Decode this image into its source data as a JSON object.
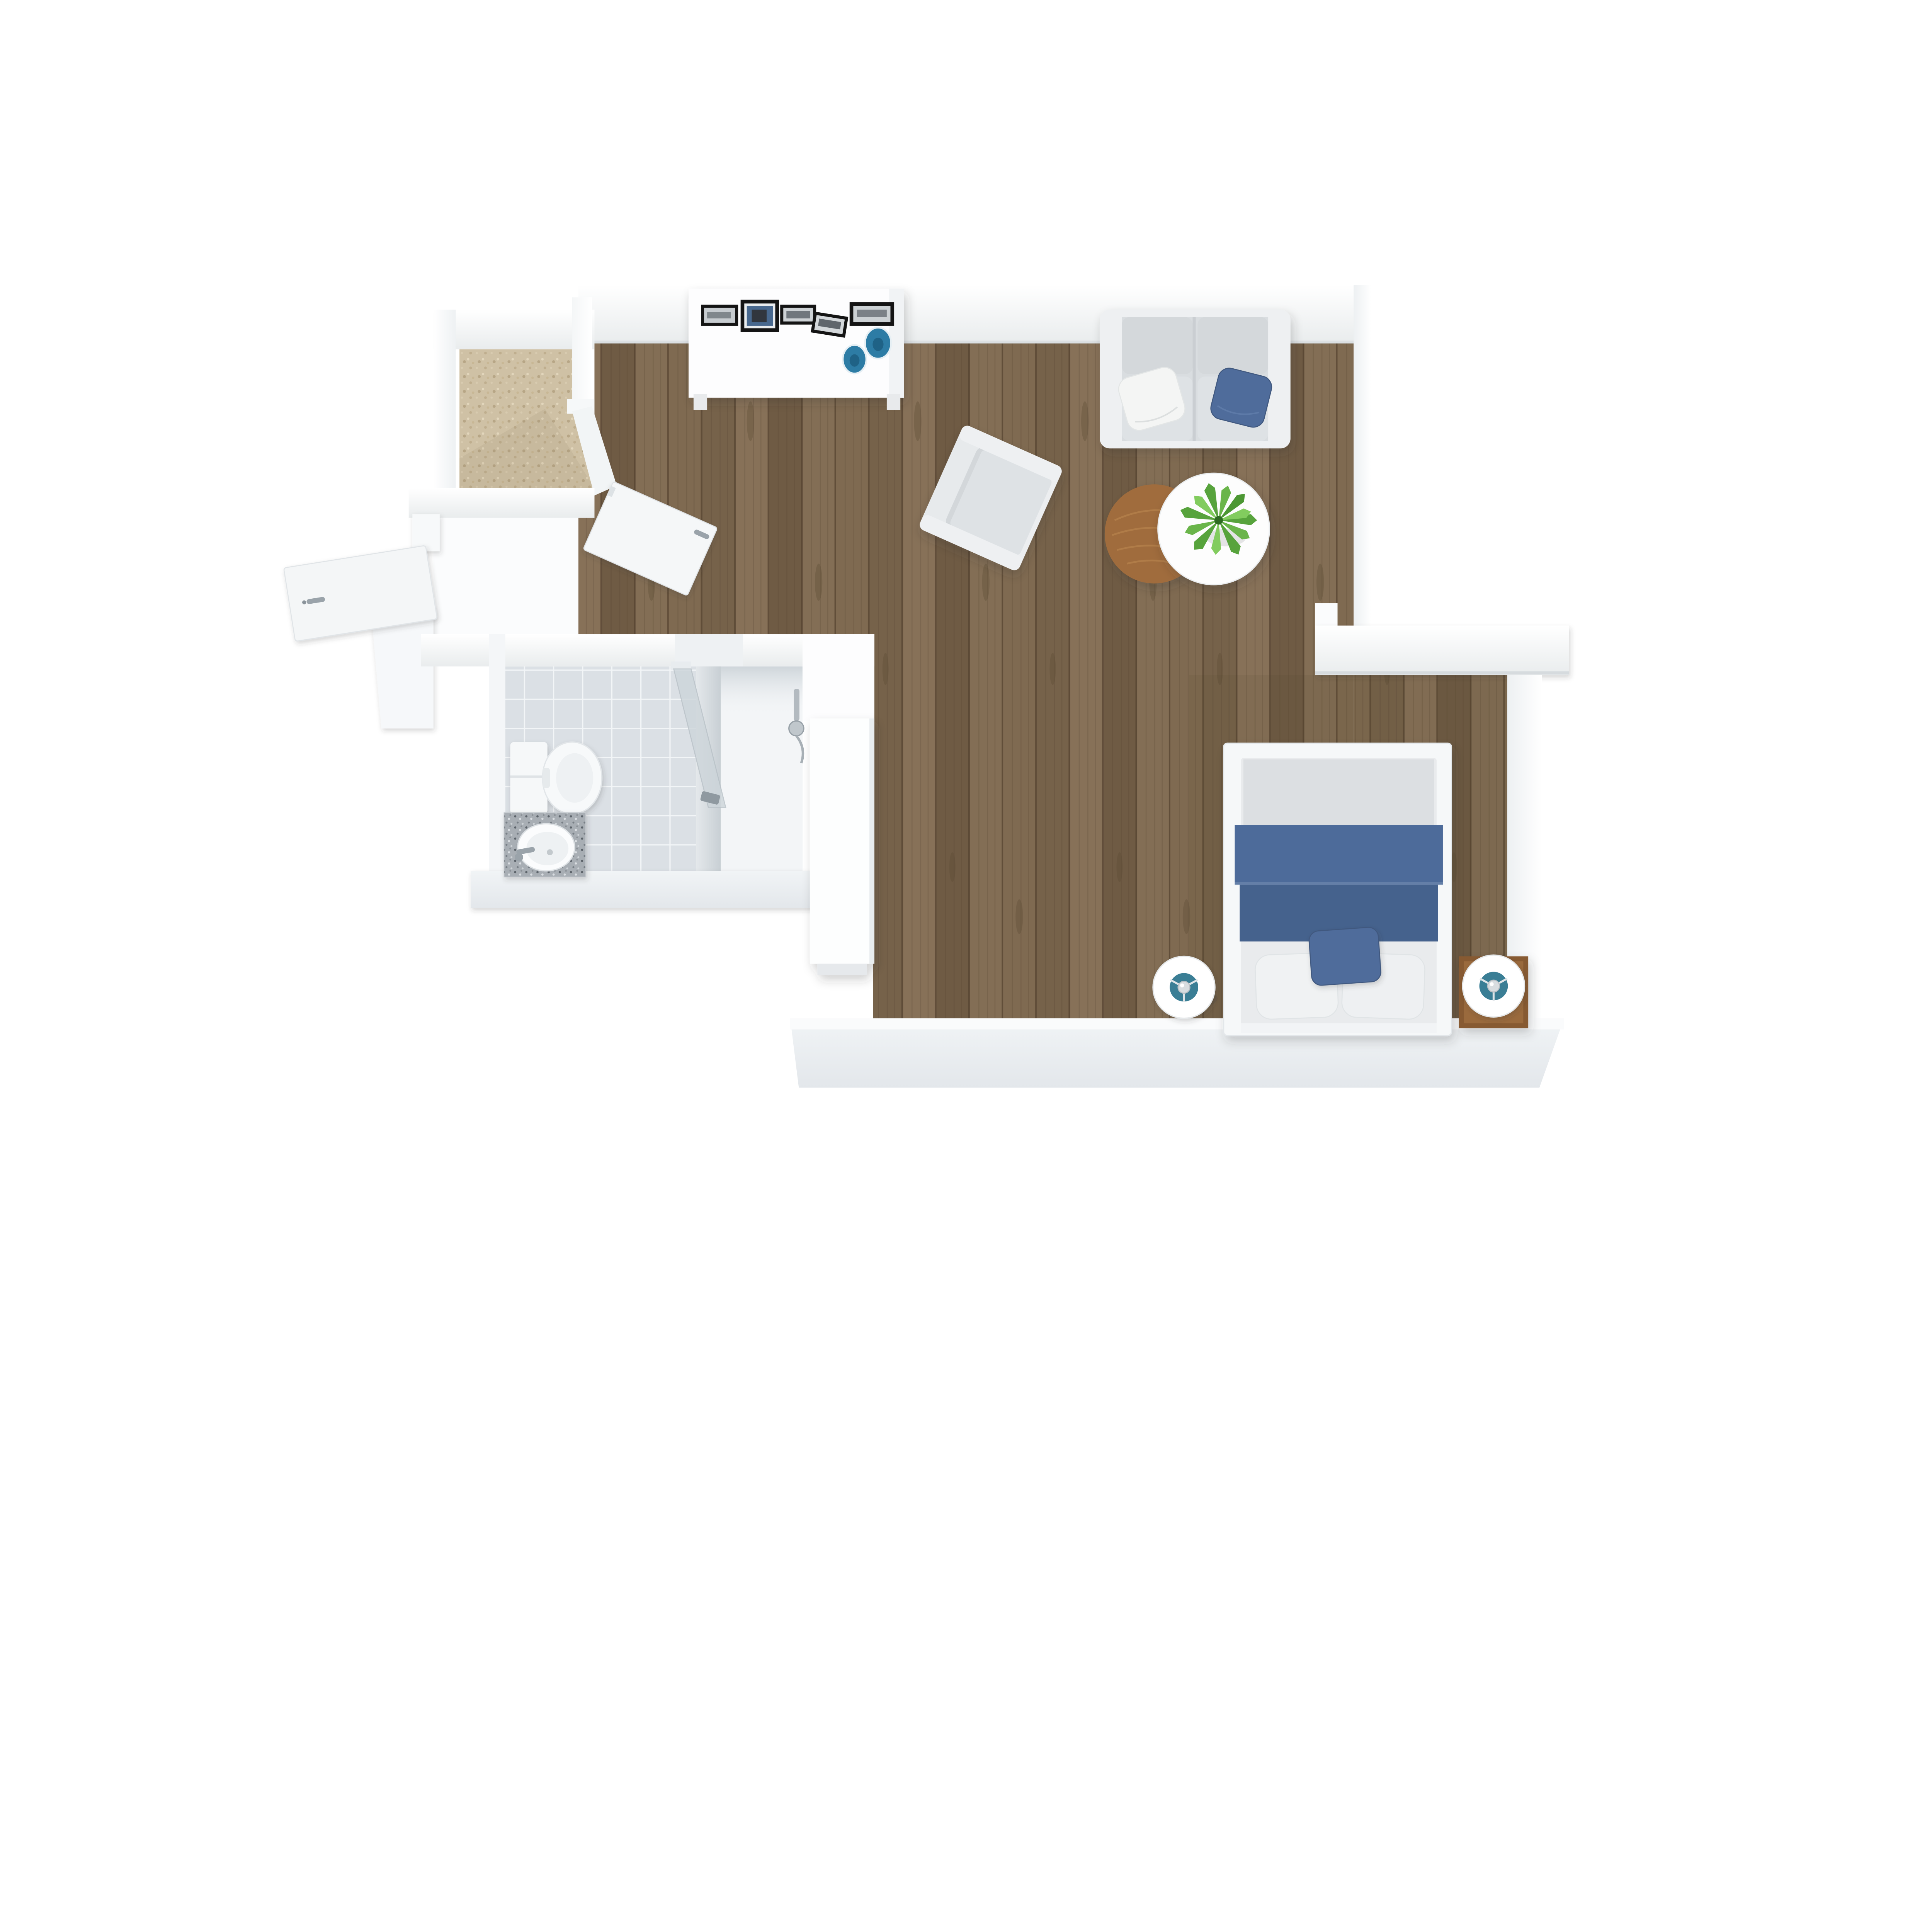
{
  "scene": {
    "type": "3d-floor-plan-top-view",
    "description": "Top-down 3D rendered floor plan of a studio apartment with living room, bedroom nook, bathroom, shower, walk-in closet and entry hall",
    "background": "#ffffff"
  },
  "colors": {
    "wall": "#ffffff",
    "wall_shade": "#e9eced",
    "wall_line": "#cfd5d9",
    "wall_face_bottom": "#e3e7eb",
    "wood_base": "#7f6a51",
    "wood_dark": "#55432f",
    "carpet": "#cfc1a5",
    "tile": "#dbe0e5",
    "tile_grout": "#f2f5f7",
    "shower_floor": "#f3f5f7",
    "sofa_frame": "#eef0f2",
    "sofa_fabric": "#d9dde0",
    "seat_fabric": "#dee2e5",
    "pillow_white": "#f4f5f4",
    "accent_blue": "#4f6c9b",
    "blanket_blue_top": "#4d6b9a",
    "blanket_blue_bottom": "#45628d",
    "plate_blue": "#2d7ca5",
    "lamp_teal": "#3a7e95",
    "plant_green": "#57a33c",
    "table_wood": "#a06c3c",
    "nightstand_wood": "#875a33",
    "granite": "#a8aeb4",
    "chrome": "#9aa3aa",
    "frame_black": "#141414",
    "mattress": "#e9ebed",
    "duvet_head": "#dcdfe2",
    "glass": "#cdd5da"
  },
  "rooms": [
    {
      "id": "living-room",
      "name": "Living room",
      "floor": "wood planks"
    },
    {
      "id": "bedroom-nook",
      "name": "Bedroom nook",
      "floor": "wood planks"
    },
    {
      "id": "walk-in-closet",
      "name": "Walk-in closet",
      "floor": "beige carpet"
    },
    {
      "id": "bathroom",
      "name": "Bathroom",
      "floor": "grey tile"
    },
    {
      "id": "shower",
      "name": "Shower stall",
      "floor": "white"
    },
    {
      "id": "entry-hall",
      "name": "Entry hall",
      "floor": "white threshold"
    }
  ],
  "furniture": [
    {
      "id": "media-console",
      "room": "living-room",
      "label": "White sideboard with 5 framed pictures and 2 blue plates"
    },
    {
      "id": "sofa",
      "room": "living-room",
      "label": "Two-seat grey sofa with one white and one blue pillow"
    },
    {
      "id": "armchair",
      "room": "living-room",
      "label": "Grey upholstered armchair, rotated"
    },
    {
      "id": "coffee-table-wood",
      "room": "living-room",
      "label": "Round wooden nesting coffee table"
    },
    {
      "id": "coffee-table-white",
      "room": "living-room",
      "label": "Round white nesting coffee table"
    },
    {
      "id": "plant",
      "room": "living-room",
      "label": "Green potted plant on white table"
    },
    {
      "id": "bed",
      "room": "bedroom-nook",
      "label": "Bed with white frame, grey duvet, blue blanket, white pillows and blue accent pillow"
    },
    {
      "id": "lamp-left",
      "room": "bedroom-nook",
      "label": "Round white table lamp with teal shade center"
    },
    {
      "id": "lamp-right",
      "room": "bedroom-nook",
      "label": "Round white table lamp with teal shade center"
    },
    {
      "id": "nightstand-right",
      "room": "bedroom-nook",
      "label": "Square wooden nightstand"
    },
    {
      "id": "toilet",
      "room": "bathroom",
      "label": "White toilet with cistern cabinet"
    },
    {
      "id": "vanity-sink",
      "room": "bathroom",
      "label": "Granite vanity with oval sink and chrome faucet"
    },
    {
      "id": "shower-door",
      "room": "bathroom",
      "label": "Glass shower door, ajar"
    },
    {
      "id": "shower-fixture",
      "room": "shower",
      "label": "Chrome shower fixture"
    },
    {
      "id": "wardrobe",
      "room": "shower",
      "label": "Tall white wardrobe cabinet"
    },
    {
      "id": "entry-door",
      "room": "entry-hall",
      "label": "White entry door, open"
    },
    {
      "id": "interior-door",
      "room": "living-room",
      "label": "White interior door, open into living room"
    }
  ]
}
